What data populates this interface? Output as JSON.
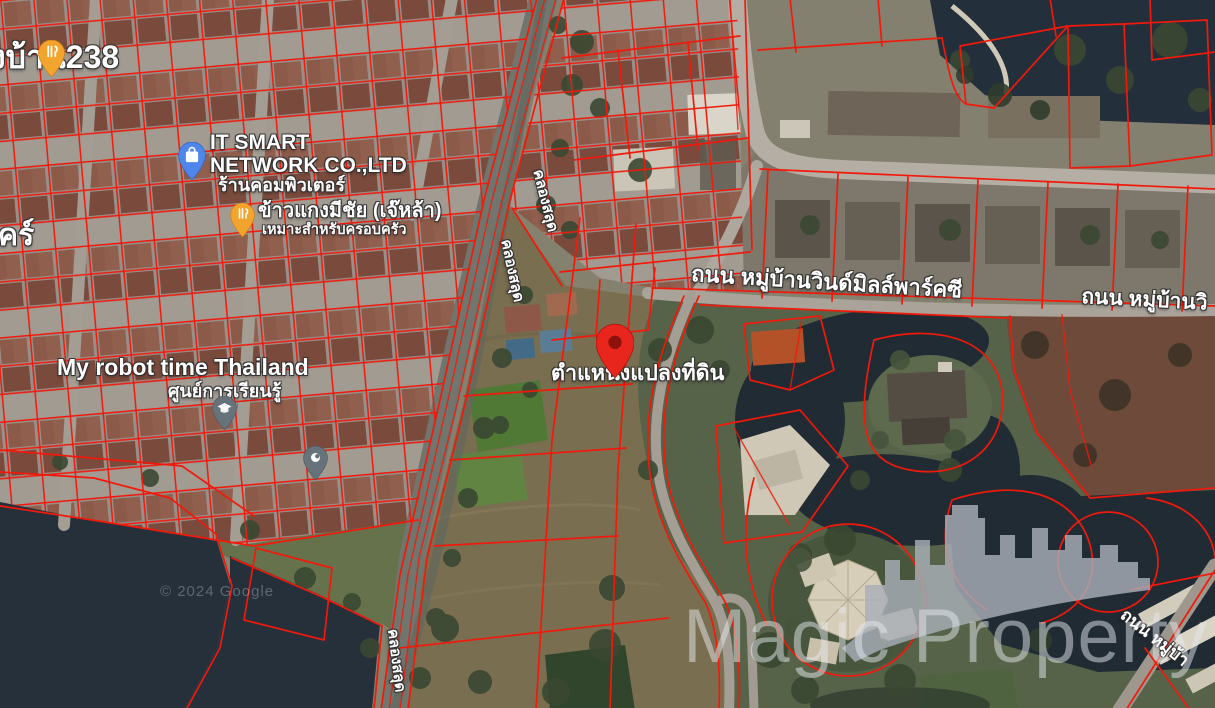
{
  "colors": {
    "parcel": "#f2190a",
    "pin": "#e8261d",
    "water": "#25303b",
    "canal": "#70756d",
    "road": "#b4aea4",
    "watermark": "rgba(228,231,235,0.50)",
    "attribution": "rgba(195,205,220,0.35)"
  },
  "pois": {
    "village238": {
      "label": "งบ้าน238"
    },
    "left_partial": {
      "label": "คร์"
    },
    "it_smart": {
      "line1": "IT SMART",
      "line2": "NETWORK CO.,LTD",
      "sub": "ร้านคอมพิวเตอร์"
    },
    "restaurant": {
      "label": "ข้าวแกงมีชัย (เจ๊หล้า)",
      "sub": "เหมาะสำหรับครอบครัว"
    },
    "robot_school": {
      "label": "My robot time Thailand",
      "sub": "ศูนย์การเรียนรู้"
    }
  },
  "marker": {
    "label": "ตำแหน่งแปลงที่ดิน"
  },
  "roads": {
    "windmill_park": {
      "label": "ถนน หมู่บ้านวินด์มิลล์พาร์คซี"
    },
    "windmill_park_right": {
      "label": "ถนน หมู่บ้านวิ"
    },
    "village_road_br": {
      "label": "ถนน หมู่บ้า"
    }
  },
  "waterway": {
    "khlong": {
      "label": "คลองสลุด"
    }
  },
  "watermark": {
    "text": "Magic Property"
  },
  "attribution": {
    "text": "© 2024 Google"
  }
}
